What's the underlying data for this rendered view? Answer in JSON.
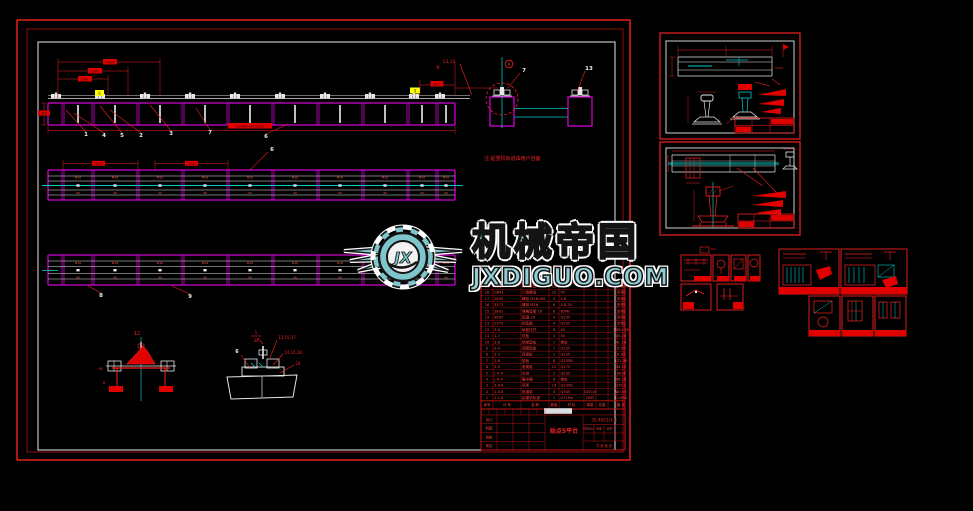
{
  "colors": {
    "red": "#f22222",
    "red_fill": "#e00000",
    "magenta": "#cf00cf",
    "cyan": "#00c8c8",
    "white_line": "#e6e6e6",
    "yellow": "#ffff00",
    "teal_logo": "#7fc6cc",
    "background": "#000000"
  },
  "watermark": {
    "brand": "机械帝国",
    "domain": "JXDIGUO.COM",
    "monogram": "JX"
  },
  "main": {
    "note": "注 起重机轨道由用户自备",
    "beam1": {
      "balloons": [
        "1",
        "4",
        "5",
        "2",
        "3",
        "7",
        "6"
      ],
      "dims_top": [
        "2000",
        "1000",
        "500"
      ],
      "dim_left": "550",
      "dim_right": "800",
      "dim_right_mark": "N",
      "dim_overall": "11000=22×500",
      "pair_label": "13,14",
      "section_mark": "A",
      "balloon_j": "7",
      "balloon_l": "13",
      "yellow_tags": [
        "8",
        "8"
      ]
    },
    "beam2": {
      "dim1": "500",
      "dim2": "500",
      "balloon": "6",
      "bay_top": "M16",
      "bay_bot": "40"
    },
    "beam3": {
      "balloons": [
        "8",
        "9"
      ],
      "bay_top": "M16",
      "bay_bot": "40"
    },
    "detail1": {
      "balloon": "12",
      "dim_a": "65",
      "dim_b": "6"
    },
    "detail2": {
      "ref_num": "1",
      "ref_den": "34",
      "callouts": [
        "13,15,17",
        "14,16,28",
        "24"
      ],
      "balloon": "6"
    },
    "bom": {
      "headers": [
        "序号",
        "代 号",
        "名 称",
        "数量",
        "材 料",
        "单重",
        "总重",
        "备 注"
      ],
      "rows": [
        [
          "19",
          "GB80",
          "方头螺栓",
          "12",
          "45",
          "",
          "",
          "外购"
        ],
        [
          "18",
          "GB41",
          "六角螺母",
          "12",
          "45",
          "",
          "",
          "外购"
        ],
        [
          "17",
          "2659",
          "螺栓 M16×65",
          "3",
          "4.8",
          "",
          "",
          "外购"
        ],
        [
          "16",
          "3373",
          "螺母 M16",
          "6",
          "4.8-Zn",
          "",
          "",
          "外购"
        ],
        [
          "15",
          "2801",
          "弹簧垫圈 16",
          "6",
          "65Mn",
          "",
          "",
          "外购"
        ],
        [
          "14",
          "4697",
          "垫圈 16",
          "4",
          "Q235",
          "",
          "",
          "外购"
        ],
        [
          "13",
          "2379",
          "斜垫圈",
          "4",
          "Q235",
          "",
          "",
          "外购"
        ],
        [
          "12",
          "3-6",
          "轨距拉杆",
          "8",
          "45",
          "",
          "",
          "M65×28"
        ],
        [
          "11",
          "1-7",
          "压板",
          "3",
          "45",
          "",
          "",
          "43-26"
        ],
        [
          "10",
          "3-8",
          "绝缘垫板",
          "1",
          "橡胶",
          "",
          "",
          "4L 26"
        ],
        [
          "9",
          "3-4",
          "调整垫板",
          "1",
          "Q235",
          "",
          "",
          "4.35"
        ],
        [
          "8",
          "3-3",
          "连接板",
          "1",
          "Q235",
          "",
          "",
          "4.35"
        ],
        [
          "7",
          "1-8",
          "垫板",
          "8",
          "Q235B",
          "",
          "",
          "172.35"
        ],
        [
          "6",
          "3-5",
          "鱼尾板",
          "15",
          "Q275",
          "",
          "",
          "38.25"
        ],
        [
          "5",
          "L-4-0",
          "车挡",
          "2",
          "Q235",
          "",
          "",
          "96.4"
        ],
        [
          "4",
          "L-6-0",
          "缓冲器",
          "8",
          "橡胶",
          "",
          "",
          "96.18"
        ],
        [
          "3",
          "3-8-8",
          "吊架",
          "14",
          "Q235B",
          "",
          "",
          "145.2"
        ],
        [
          "2",
          "1-5-8",
          "轨道梁",
          "4",
          "Q345",
          "1450.6",
          "",
          "W=26"
        ],
        [
          "1",
          "1-1-8",
          "起重机轨道",
          "1",
          "U71Mn",
          "1835",
          "",
          "L=960"
        ]
      ]
    },
    "title_block": {
      "title": "始点5平台",
      "drawing_no": "35.4001/1-8",
      "left_labels": [
        "设计",
        "制图",
        "校核",
        "审定"
      ],
      "right_labels": [
        "阶段标记",
        "重量",
        "比例"
      ],
      "sheet_info": "共 张 第 张"
    }
  }
}
